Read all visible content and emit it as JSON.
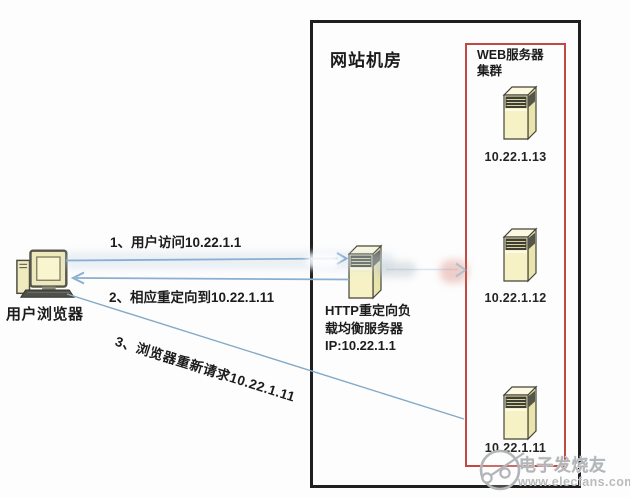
{
  "colors": {
    "room_border": "#1f1f1f",
    "cluster_border": "#bf4a44",
    "arrow_blue": "#8aafd0",
    "server_fill": "#f6f2c6",
    "text": "#1c1c1c",
    "watermark_gray": "#b7babc"
  },
  "diagram": {
    "user": {
      "label": "用户浏览器",
      "icon": "desktop-computer-icon"
    },
    "server_room": {
      "title": "网站机房"
    },
    "load_balancer": {
      "icon": "server-tower-icon",
      "label_line1": "HTTP重定向负",
      "label_line2": "载均衡服务器",
      "label_line3": "IP:10.22.1.1"
    },
    "cluster": {
      "title_line1": "WEB服务器",
      "title_line2": "集群",
      "servers": [
        {
          "ip": "10.22.1.13",
          "icon": "server-tower-icon"
        },
        {
          "ip": "10.22.1.12",
          "icon": "server-tower-icon"
        },
        {
          "ip": "10.22.1.11",
          "icon": "server-tower-icon"
        }
      ]
    },
    "arrows": [
      {
        "step": "1",
        "label": "1、用户访问10.22.1.1"
      },
      {
        "step": "2",
        "label": "2、相应重定向到10.22.1.11"
      },
      {
        "step": "3",
        "label": "3、浏览器重新请求10.22.1.11"
      }
    ]
  },
  "watermark": {
    "brand": "电子发烧友",
    "site": "www.elecfans.com",
    "logo_icon": "elecfans-logo-icon"
  }
}
